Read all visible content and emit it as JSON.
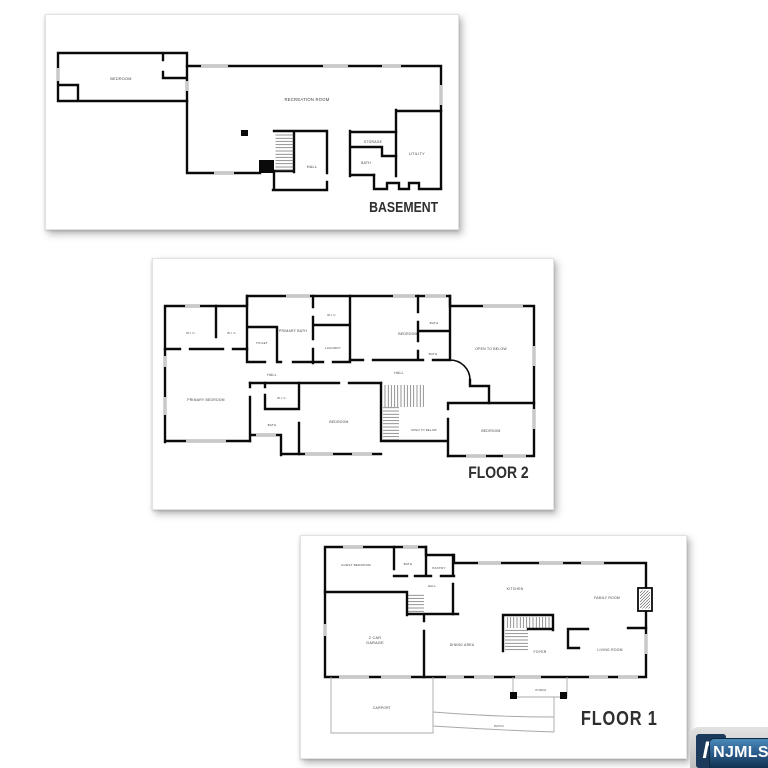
{
  "panels": {
    "basement": {
      "title": "BASEMENT",
      "rooms": {
        "bedroom": "BEDROOM",
        "recreation": "RECREATION ROOM",
        "hall": "HALL",
        "storage": "STORAGE",
        "bath": "BATH",
        "utility": "UTILITY"
      }
    },
    "floor2": {
      "title": "FLOOR 2",
      "rooms": {
        "wic1": "W.I.C.",
        "wic2": "W.I.C.",
        "toilet": "TOILET",
        "primary_bath": "PRIMARY BATH",
        "wic3": "W.I.C.",
        "laundry": "LAUNDRY",
        "bedroom_top": "BEDROOM",
        "bath_top": "BATH",
        "bath_mid": "BATH",
        "open_below_right": "OPEN TO BELOW",
        "hall_left": "HALL",
        "hall_right": "HALL",
        "primary_bedroom": "PRIMARY BEDROOM",
        "wic4": "W.I.C.",
        "bath_left": "BATH",
        "bedroom_mid": "BEDROOM",
        "open_below_stairs": "OPEN TO BELOW",
        "bedroom_right": "BEDROOM"
      }
    },
    "floor1": {
      "title": "FLOOR 1",
      "rooms": {
        "guest_bedroom": "GUEST BEDROOM",
        "bath": "BATH",
        "pantry": "PANTRY",
        "hall": "HALL",
        "kitchen": "KITCHEN",
        "family_room": "FAMILY ROOM",
        "garage_line1": "2 CAR",
        "garage_line2": "GARAGE",
        "dining": "DINING AREA",
        "foyer": "FOYER",
        "living": "LIVING ROOM",
        "porch": "PORCH",
        "carport": "CARPORT",
        "patio": "PATIO"
      }
    }
  },
  "watermark": {
    "initial": "N",
    "label": "NJMLS"
  },
  "colors": {
    "wall": "#0a0a0a",
    "window": "#c9c9c9",
    "title": "#2e2e2e",
    "logo_navy": "#1c3a5c",
    "logo_blue": "#4a8ab8",
    "tab_gray": "#bfbfbf"
  }
}
